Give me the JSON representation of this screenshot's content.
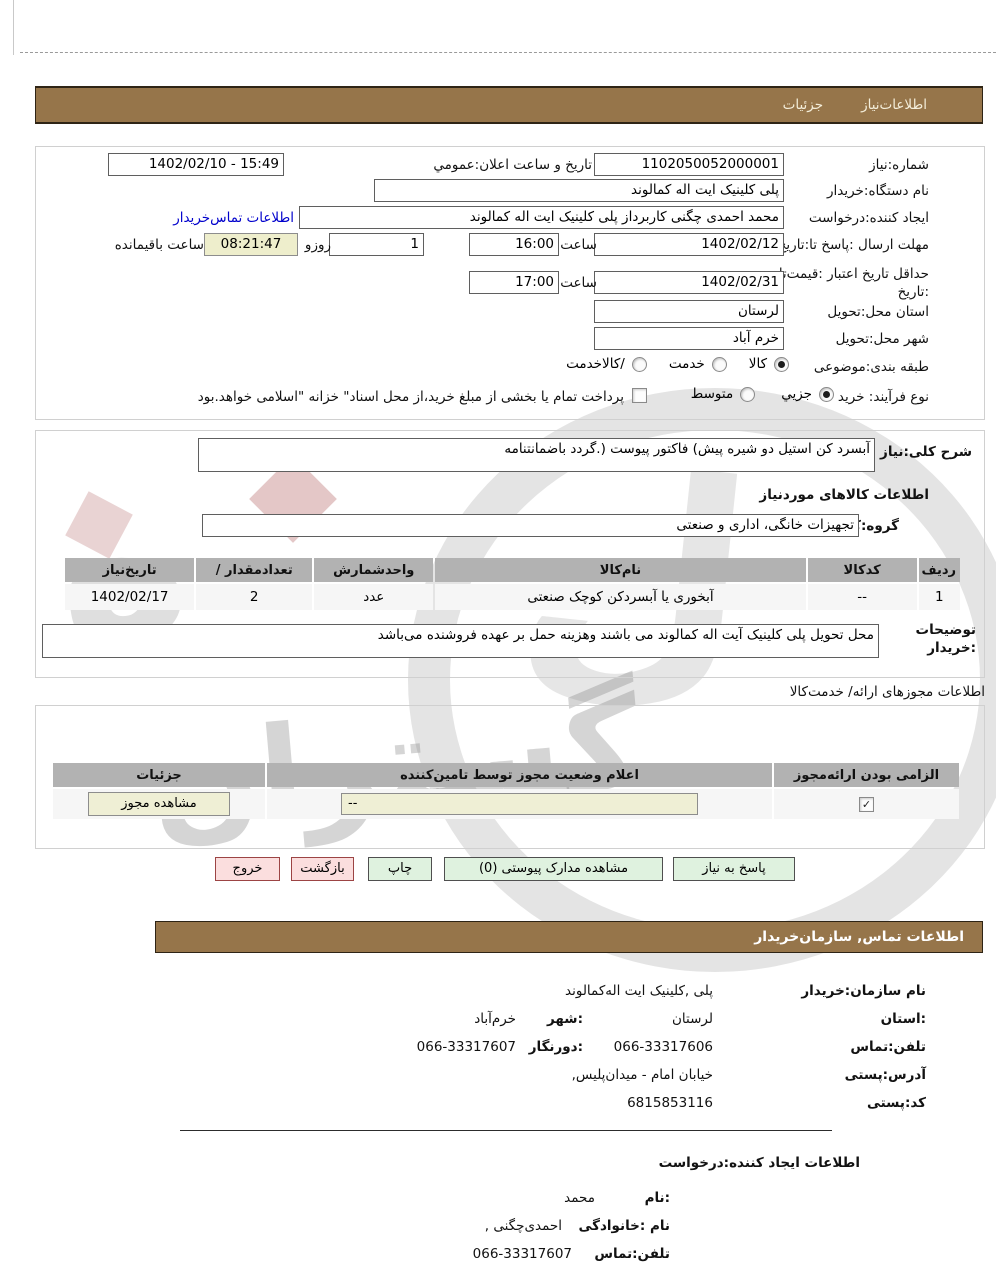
{
  "header": {
    "tab_need_info": "اطلاعات‌نیاز",
    "tab_details": "جزئیات"
  },
  "need": {
    "number_label": "شماره:نیاز",
    "number_value": "1102050052000001",
    "announce_label": "تاریخ و ساعت اعلان:عمومي",
    "announce_value": "15:49 - 1402/02/10",
    "device_label": "نام دستگاه:خریدار",
    "device_value": "پلی کلینیک ایت اله کمالوند",
    "creator_label": "ایجاد کننده:درخواست",
    "creator_value": "محمد احمدی چگنی کاربرداز پلی کلینیک ایت اله کمالوند",
    "buyer_contact_link": "اطلاعات تماس‌خریدار",
    "deadline_label": "مهلت ارسال :پاسخ تا:تاریخ",
    "deadline_date": "1402/02/12",
    "hour_label": "ساعت",
    "deadline_time": "16:00",
    "days_value": "1",
    "days_label": "روزو",
    "remaining_value": "08:21:47",
    "remaining_label": "ساعت باقیمانده",
    "validity_label_1": "حداقل تاریخ اعتبار :قیمت‌تا",
    "validity_label_2": ":تاریخ",
    "validity_date": "1402/02/31",
    "validity_time": "17:00",
    "province_label": "استان محل:تحویل",
    "province_value": "لرستان",
    "city_label": "شهر محل:تحویل",
    "city_value": "خرم آباد",
    "classification_label": "طبقه بندی:موضوعی",
    "class_goods": "کالا",
    "class_service": "خدمت",
    "class_both": "/کالاخدمت",
    "process_label": "نوع فرآیند: خرید",
    "process_partial": "جزيي",
    "process_medium": "متوسط",
    "treasury_note": "پرداخت تمام یا بخشی از مبلغ خرید،از محل اسناد\" خزانه \"اسلامی خواهد.بود"
  },
  "description": {
    "label": "شرح کلی:نیاز",
    "value": "آبسرد کن استیل دو شیره پیش) فاکتور پیوست (.گردد باضمانتنامه",
    "goods_info_heading": "اطلاعات کالاهای موردنیاز",
    "group_label": "گروه:کالا",
    "group_value": "تجهیزات خانگی، اداری و صنعتی"
  },
  "goods_table": {
    "headers": [
      "ردیف",
      "کدکالا",
      "نام‌کالا",
      "واحدشمارش",
      "تعدادمقدار /",
      "تاریخ‌نیاز"
    ],
    "rows": [
      [
        "1",
        "--",
        "آبخوری یا آبسردکن کوچک صنعتی",
        "عدد",
        "2",
        "1402/02/17"
      ]
    ]
  },
  "notes": {
    "label_1": "توضیحات",
    "label_2": ":خریدار",
    "value": "محل تحویل پلی کلینیک آیت اله کمالوند می باشند وهزینه حمل بر عهده فروشنده می‌باشد"
  },
  "license": {
    "section_title": "اطلاعات مجوزهای ارائه/ خدمت‌کالا",
    "headers": [
      "الزامی بودن ارائه‌مجوز",
      "اعلام وضعیت مجوز توسط تامین‌کننده",
      "جزئیات"
    ],
    "status_value": "--",
    "view_button": "مشاهده مجوز"
  },
  "actions": {
    "reply": "پاسخ به نیاز",
    "view_docs": "مشاهده مدارک پیوستی (0)",
    "print": "چاپ",
    "back": "بازگشت",
    "exit": "خروج"
  },
  "buyer_contact": {
    "section_title": "اطلاعات  تماس, سازمان‌خریدار",
    "org_label": "نام سازمان:خریدار",
    "org_value": "پلی ,کلینیک ایت اله‌کمالوند",
    "province_label": ":استان",
    "province_value": "لرستان",
    "city_label": ":شهر",
    "city_value": "خرم‌آباد",
    "phone_label": "تلفن:تماس",
    "phone_value": "066-33317606",
    "fax_label": ":دورنگار",
    "fax_value": "066-33317607",
    "address_label": "آدرس:پستی",
    "address_value": "خیابان امام - میدان‌پلیس,",
    "postal_label": "کد:پستی",
    "postal_value": "6815853116"
  },
  "requester": {
    "section_title": "اطلاعات ایجاد کننده:درخواست",
    "name_label": ":نام",
    "name_value": "محمد",
    "family_label": "نام :خانوادگی",
    "family_value": "احمدی‌چگنی ,",
    "phone_label": "تلفن:تماس",
    "phone_value": "066-33317607"
  },
  "watermark": {
    "text": "گستران",
    "glyph1": "ه",
    "glyph2": "ل"
  },
  "icons": {
    "check": "✓"
  },
  "colors": {
    "brand_brown": "#96754A",
    "timer_bg": "#EEEECC",
    "button_green_bg": "#DFF2DF",
    "button_pink_bg": "#FBDEDE",
    "link_blue": "#0000CC",
    "table_header_bg": "#B2B2B2",
    "beige_field_bg": "#EFEFD5"
  }
}
